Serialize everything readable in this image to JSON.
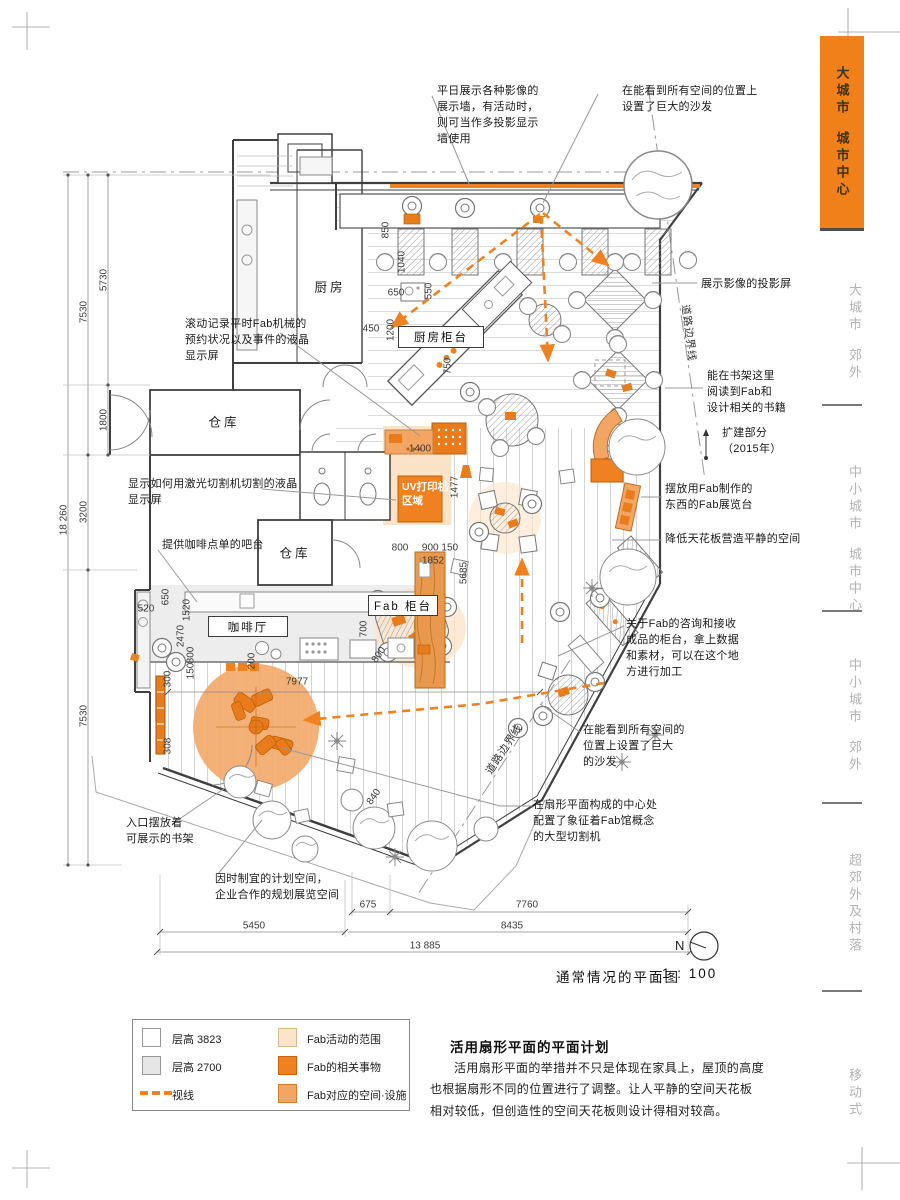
{
  "colors": {
    "accent": "#f0801a",
    "accent_mid": "#f3a564",
    "accent_light": "#fce4cb",
    "sidebar_inactive": "#b3b3b3"
  },
  "sidebar": {
    "items": [
      {
        "line1": "大城市",
        "line2": "城市中心",
        "active": true
      },
      {
        "line1": "大城市",
        "line2": "郊外",
        "active": false
      },
      {
        "line1": "中小城市",
        "line2": "城市中心",
        "active": false
      },
      {
        "line1": "中小城市",
        "line2": "郊外",
        "active": false
      },
      {
        "line1": "超郊外及村落",
        "line2": "",
        "active": false
      },
      {
        "line1": "移动式",
        "line2": "",
        "active": false
      }
    ]
  },
  "plan": {
    "title": "通常情况的平面图",
    "scale": "1 : 100",
    "north": "N"
  },
  "rooms": {
    "kitchen": "厨房",
    "storage1": "仓库",
    "storage2": "仓库",
    "kitchen_counter": "厨房柜台",
    "cafe": "咖啡厅",
    "fab_counter": "Fab 柜台",
    "uv_area": "UV打印机\n区域"
  },
  "annotations": {
    "display_wall": "平日展示各种影像的\n展示墙，有活动时，\n则可当作多投影显示\n墙使用",
    "big_sofa_top": "在能看到所有空间的位置上\n设置了巨大的沙发",
    "projector": "展示影像的投影屏",
    "lcd_schedule": "滚动记录平时Fab机械的\n预约状况以及事件的液晶\n显示屏",
    "bookshelf_read": "能在书架这里\n阅读到Fab和\n设计相关的书籍",
    "expansion": "扩建部分\n（2015年）",
    "laser_lcd": "显示如何用激光切割机切割的液晶\n显示屏",
    "fab_display_stand": "摆放用Fab制作的\n东西的Fab展览台",
    "coffee_bar": "提供咖啡点单的吧台",
    "low_ceiling": "降低天花板营造平静的空间",
    "fab_consult": "关于Fab的咨询和接收\n成品的柜台，拿上数据\n和素材，可以在这个地\n方进行加工",
    "big_sofa_bottom": "在能看到所有空间的\n位置上设置了巨大\n的沙发",
    "cutting_machine": "在扇形平面构成的中心处\n配置了象征着Fab馆概念\n的大型切割机",
    "entrance_bookshelf": "入口摆放着\n可展示的书架",
    "flexible_space": "因时制宜的计划空间，\n企业合作的规划展览空间",
    "road_boundary": "道路边界线"
  },
  "dims": {
    "d18260": "18 260",
    "d7530a": "7530",
    "d5730": "5730",
    "d1800": "1800",
    "d3200": "3200",
    "d7530b": "7530",
    "d850": "850",
    "d1040": "1040",
    "d650a": "650",
    "d550": "550",
    "d450": "450",
    "d1200": "1200",
    "d750": "750",
    "d1400": "1400",
    "d1477": "1477",
    "d800a": "800",
    "d900150": "900 150",
    "d1852": "1852",
    "d5685": "5685",
    "d520": "520",
    "d650b": "650",
    "d1520": "1520",
    "d2470": "2470",
    "d800b": "800",
    "d150b": "150",
    "d300": "300",
    "d200": "200",
    "d700": "700",
    "d800c": "800",
    "d7977": "7977",
    "d308": "308",
    "d840": "840",
    "d675": "675",
    "d7760": "7760",
    "d5450": "5450",
    "d8435": "8435",
    "d13885": "13 885"
  },
  "legend": {
    "rows_left": [
      {
        "label": "层高 3823"
      },
      {
        "label": "层高 2700"
      },
      {
        "label": "视线"
      }
    ],
    "rows_right": [
      {
        "label": "Fab活动的范围"
      },
      {
        "label": "Fab的相关事物"
      },
      {
        "label": "Fab对应的空间·设施"
      }
    ]
  },
  "description": {
    "title": "活用扇形平面的平面计划",
    "body": "活用扇形平面的举措并不只是体现在家具上，屋顶的高度也根据扇形不同的位置进行了调整。让人平静的空间天花板相对较低，但创造性的空间天花板则设计得相对较高。"
  }
}
